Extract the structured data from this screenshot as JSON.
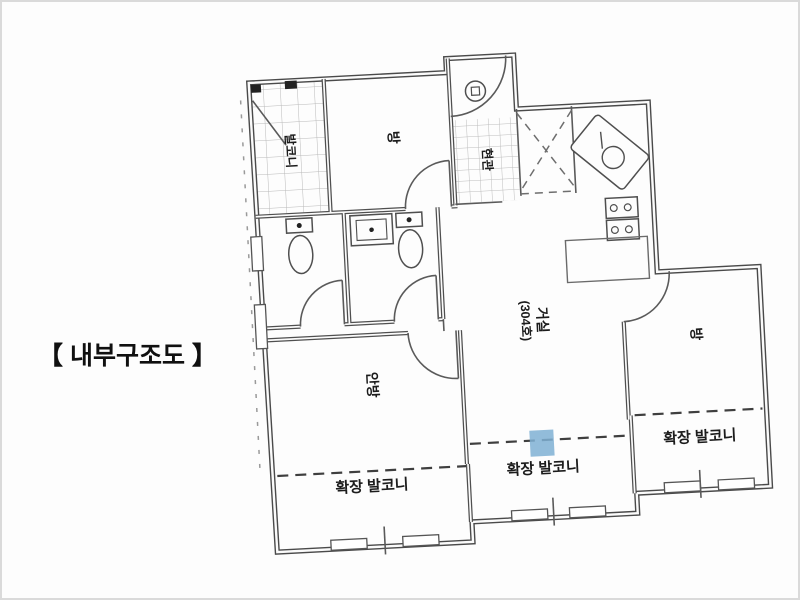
{
  "title": "【 내부구조도 】",
  "plan": {
    "rooms": {
      "balcony_upper": "발코니",
      "room_top": "방",
      "entrance": "현관",
      "living_room": "거실",
      "living_unit": "(304호)",
      "master_bedroom": "안방",
      "room_right": "방",
      "balcony_left": "확장 발코니",
      "balcony_center": "확장 발코니",
      "balcony_right": "확장 발코니"
    },
    "colors": {
      "line": "#4a4a4a",
      "highlight": "#7fb0d4"
    }
  }
}
